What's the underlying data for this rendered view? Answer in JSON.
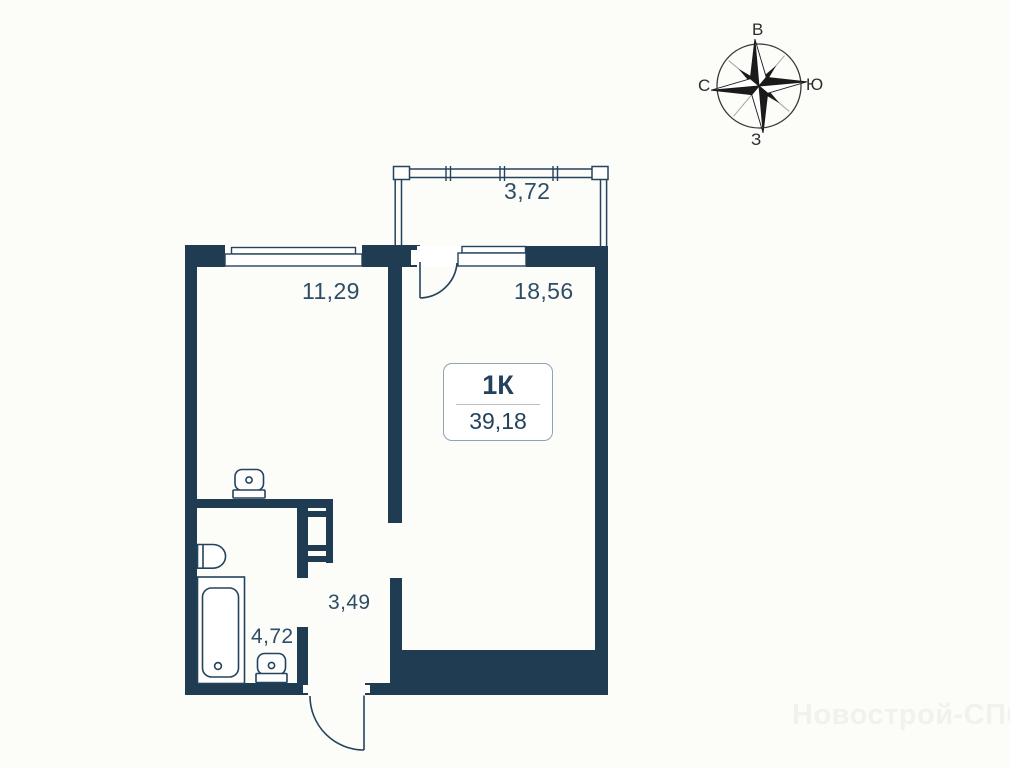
{
  "plan": {
    "unit_type_label": "1К",
    "total_area": "39,18",
    "rooms": [
      {
        "id": "balcony",
        "area": "3,72"
      },
      {
        "id": "living-room",
        "area": "11,29"
      },
      {
        "id": "room",
        "area": "18,56"
      },
      {
        "id": "hallway",
        "area": "3,49"
      },
      {
        "id": "bathroom",
        "area": "4,72"
      }
    ]
  },
  "compass": {
    "top": "В",
    "left": "С",
    "right": "Ю",
    "bottom": "З"
  },
  "watermark": "Новострой-СПб",
  "colors": {
    "wall": "#1f3c53",
    "fixture_line": "#24435c",
    "label_text": "#2e4d66",
    "box_border": "#8fa3b0",
    "watermark_text": "#f1f1ee"
  },
  "icons": {
    "compass": "compass-rose-icon",
    "toilet": "toilet-icon",
    "bathtub": "bathtub-icon",
    "sink": "sink-icon",
    "vent_shaft": "vent-shaft-icon"
  }
}
